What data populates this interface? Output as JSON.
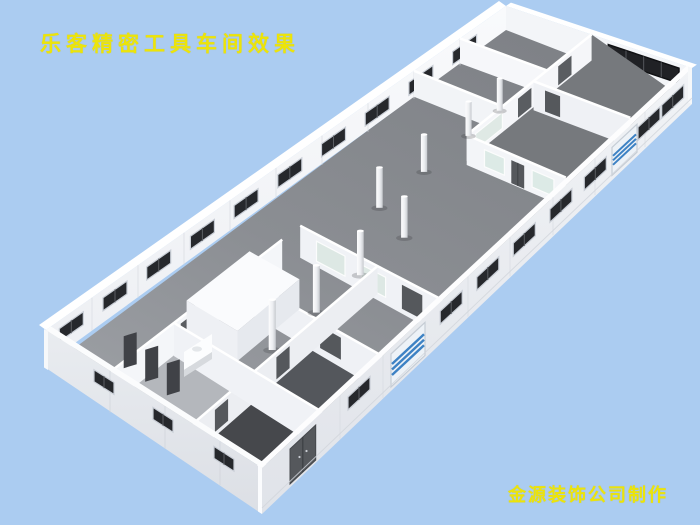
{
  "overlay": {
    "title": "乐客精密工具车间效果",
    "credit": "金源装饰公司制作",
    "text_color": "#ece409"
  },
  "scene": {
    "background_color": "#abccf1",
    "palette": {
      "wall_white": "#f6f7fa",
      "wall_outer_light": "#eef0f4",
      "wall_outer_shade": "#e2e5ea",
      "wall_cap": "#ffffff",
      "floor_gray": "#8b8e93",
      "floor_dark": "#46484c",
      "window_dark": "#26282c",
      "window_band_dark": "#202125",
      "glass_frosted": "#dfe9e5",
      "shutter_stripe_blue": "#3d82c4",
      "door_gray": "#5a5d61",
      "column_white": "#f4f5f8"
    },
    "features": {
      "upper_wall_window_count": 10,
      "lower_right_wall_window_count": 8,
      "lower_left_wall_window_count": 3,
      "column_count": 8,
      "roller_shutter_count": 2,
      "window_band_pane_count": 4,
      "interior_door_count": 10
    }
  }
}
